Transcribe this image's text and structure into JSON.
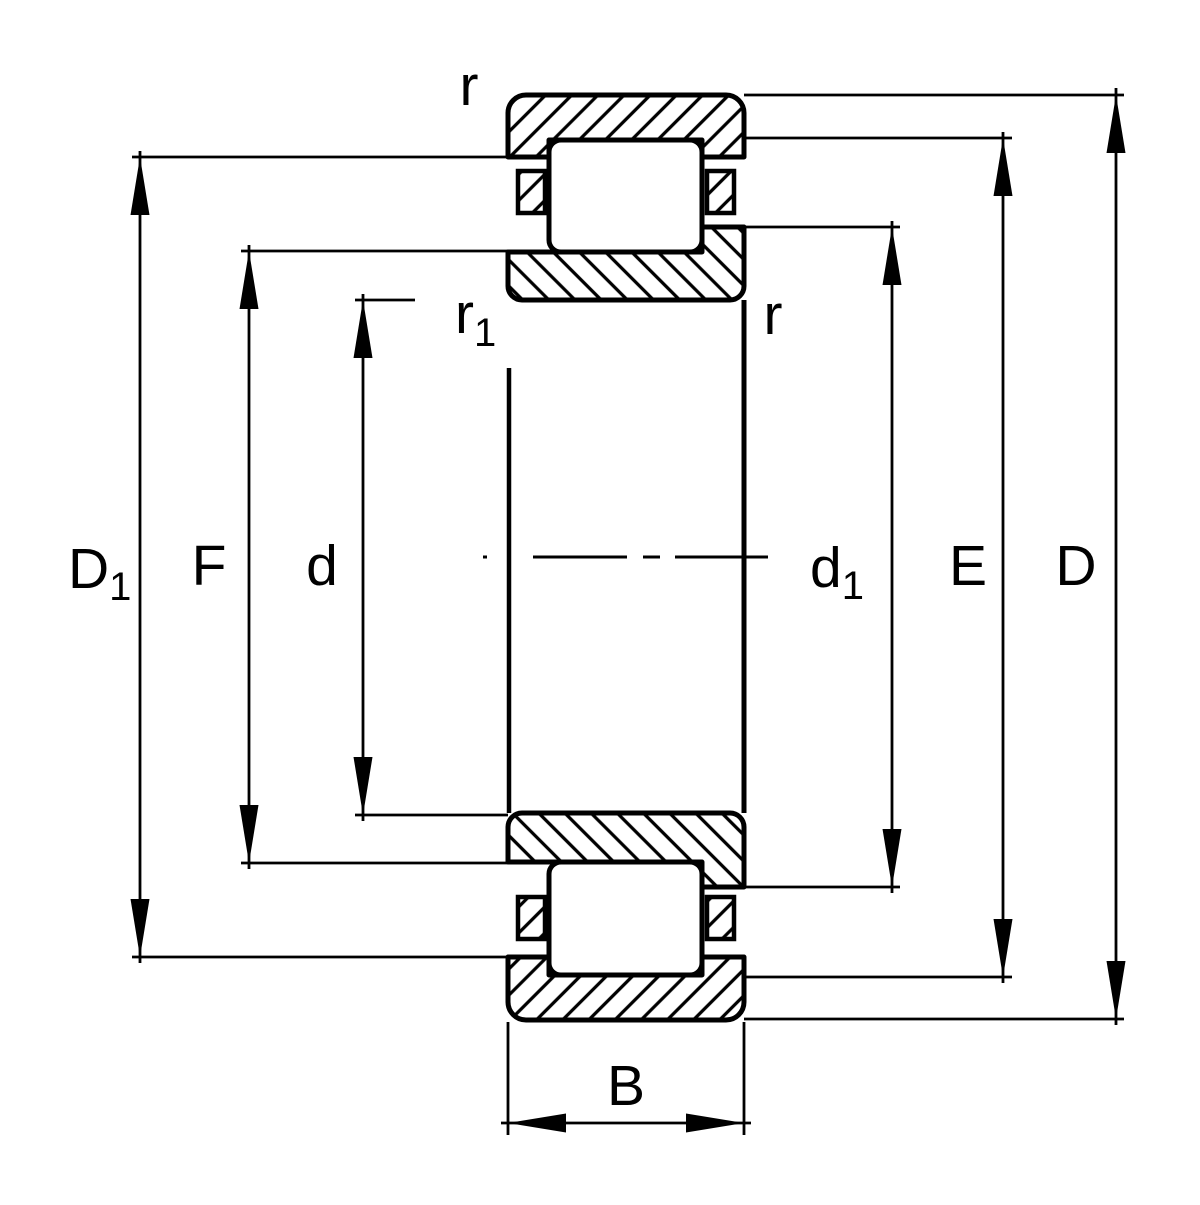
{
  "drawing": {
    "type": "bearing-cross-section-dimension-drawing",
    "background_color": "#ffffff",
    "line_color": "#000000",
    "labels": {
      "D1": {
        "base": "D",
        "sub": "1"
      },
      "F": "F",
      "d": "d",
      "r_top": "r",
      "r1": {
        "base": "r",
        "sub": "1"
      },
      "r_right": "r",
      "d1": {
        "base": "d",
        "sub": "1"
      },
      "E": "E",
      "D": "D",
      "B": "B"
    }
  }
}
